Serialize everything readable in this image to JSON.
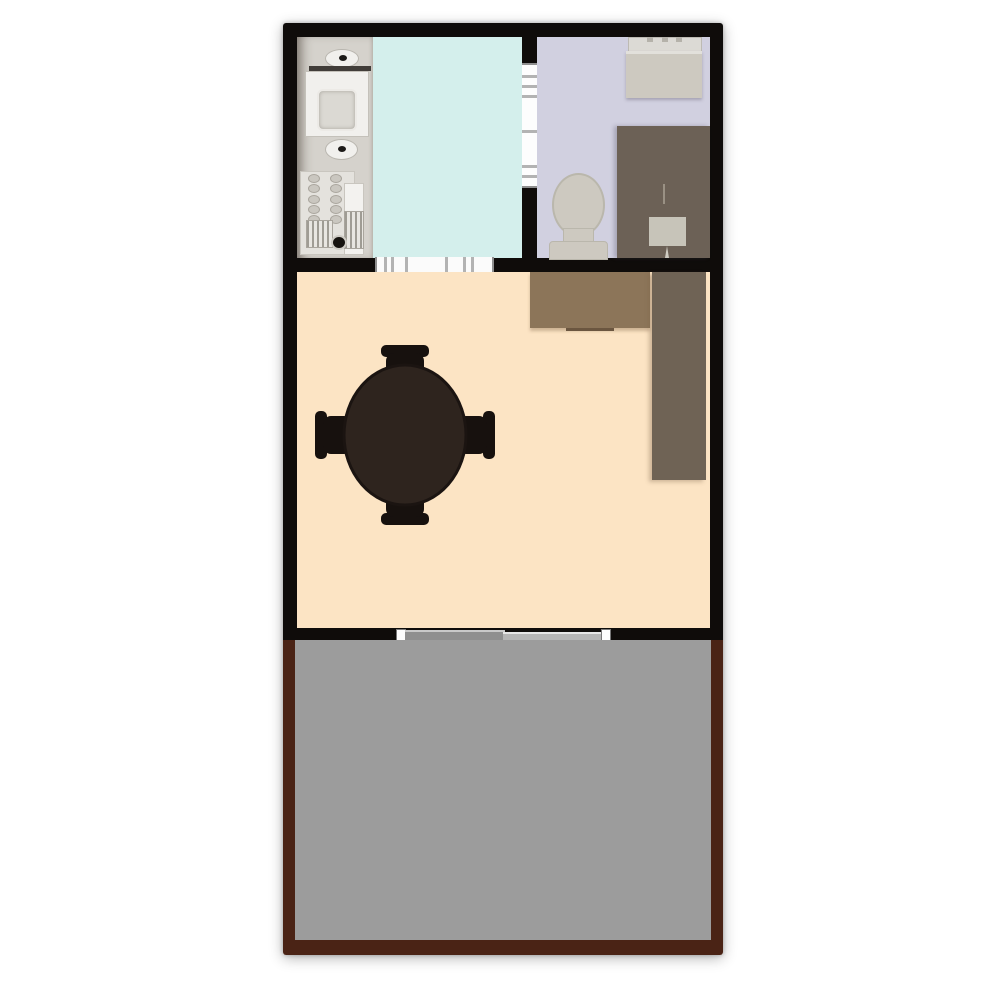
{
  "app": {
    "type": "floor-plan-viewer",
    "background": "#ffffff",
    "visible_text": "none"
  },
  "colors": {
    "wall": "#0f0c0a",
    "kitchen_counter": "#d5d2cc",
    "kitchen_floor": "#d4efec",
    "bedroom_floor": "#d1d0e0",
    "living_floor": "#fce4c4",
    "terrace_floor": "#9c9c9c",
    "terrace_frame": "#4a2315",
    "wood_light": "#8c7559",
    "wood_dark": "#6f6355",
    "bedroom_desk": "#6c6156",
    "furniture_light": "#cdc9c0",
    "furniture_lighter": "#dcdad5",
    "fixture_white": "#f1f0ed",
    "table_wood": "#2e241e",
    "chair_dark": "#17110e",
    "door_panel_dark": "#8f8f8f",
    "door_panel_light": "#b5b5b5"
  },
  "plan": {
    "rooms": [
      {
        "id": "kitchen",
        "floor_color": "kitchen_floor",
        "fixtures": [
          "counter-strip",
          "faucet",
          "sink",
          "faucet",
          "stove",
          "grill",
          "grill"
        ]
      },
      {
        "id": "bedroom",
        "floor_color": "bedroom_floor",
        "fixtures": [
          "dresser",
          "armchair",
          "desk",
          "table-lamp"
        ]
      },
      {
        "id": "living-dining",
        "floor_color": "living_floor",
        "fixtures": [
          "sideboard",
          "wardrobe",
          "round-dining-table",
          "4-chairs"
        ]
      },
      {
        "id": "terrace",
        "floor_color": "terrace_floor",
        "fixtures": []
      }
    ],
    "openings": [
      "divider-window",
      "kitchen-window",
      "sliding-door"
    ],
    "dining_set": {
      "table_shape": "round",
      "chair_count": 4
    },
    "stove_knobs": {
      "rows": 5,
      "cols": 2
    }
  }
}
